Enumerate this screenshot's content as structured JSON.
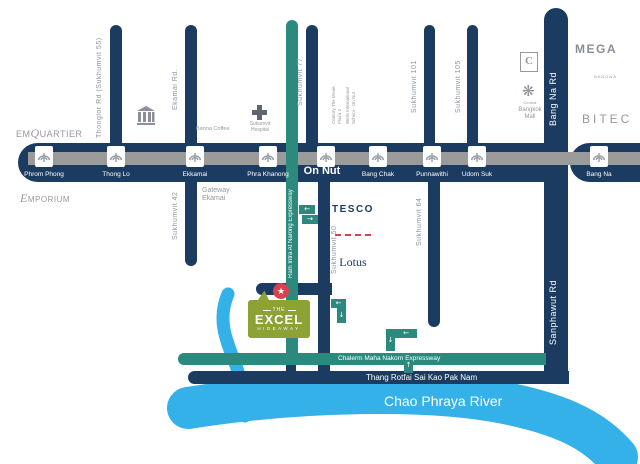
{
  "title": "The Excel Hideaway location map",
  "colors": {
    "navy": "#1b3b61",
    "track_gray": "#9b9b9b",
    "teal": "#2b8a7d",
    "water_blue": "#33b1e8",
    "logo_green": "#8ca234",
    "marker_red": "#d9414e",
    "label_gray": "#8d97a3"
  },
  "bts": {
    "stations": [
      {
        "label": "Phrom Phong"
      },
      {
        "label": "Thong Lo"
      },
      {
        "label": "Ekkamai"
      },
      {
        "label": "Phra Khanong"
      },
      {
        "label": "On Nut"
      },
      {
        "label": "Bang Chak"
      },
      {
        "label": "Punnawithi"
      },
      {
        "label": "Udom Suk"
      },
      {
        "label": "Bang Na"
      }
    ]
  },
  "roads": {
    "thonglor": "Thonglor Rd (Sukhumvit 55)",
    "ekamai": "Ekamai Rd.",
    "sukhumvit77": "Sukhumvit 77",
    "sukhumvit101": "Sukhumvit 101",
    "sukhumvit105": "Sukhumvit 105",
    "bangna": "Bang Na Rd",
    "sukhumvit42": "Sukhumvit 42",
    "sukhumvit50": "Sukhumvit 50",
    "sukhumvit64": "Sukhumvit 64",
    "sanphawut": "Sanphawut Rd",
    "ram_intra": "Ram Intra At Narong Expressway",
    "chalerm": "Chalerm Maha Nakorn Expressway",
    "thang_rotfai": "Thang Rotfai Sai Kao Pak Nam"
  },
  "landmarks": {
    "emquartier": {
      "p1": "EM",
      "p2": "Q",
      "p3": "UARTIER"
    },
    "emporium": {
      "p1": "E",
      "p2": "MPORIUM"
    },
    "banna_coffee": "Banna Coffee",
    "hospital": "Sukumvit\nHospital",
    "gateway": "Gateway\nEkamai",
    "tesco": {
      "line1": "TESCO",
      "line2": "Lotus"
    },
    "century": "Century The Movie\nPlaza 2",
    "wells": "Wells International\nSchool - On Nut",
    "mega": {
      "line1": "MEGA",
      "line2": "BANGNA"
    },
    "central_caption": "Central",
    "bangkok_mall": "Bangkok\nMall",
    "bitec": "BITEC"
  },
  "river_label": "Chao Phraya River",
  "excel": {
    "the": "THE",
    "name": "EXCEL",
    "sub": "HIDEAWAY",
    "star": "★"
  },
  "oneway": {
    "left": "←",
    "right": "→",
    "up": "↑",
    "down": "↓"
  },
  "icons": {
    "flower": "❋"
  }
}
